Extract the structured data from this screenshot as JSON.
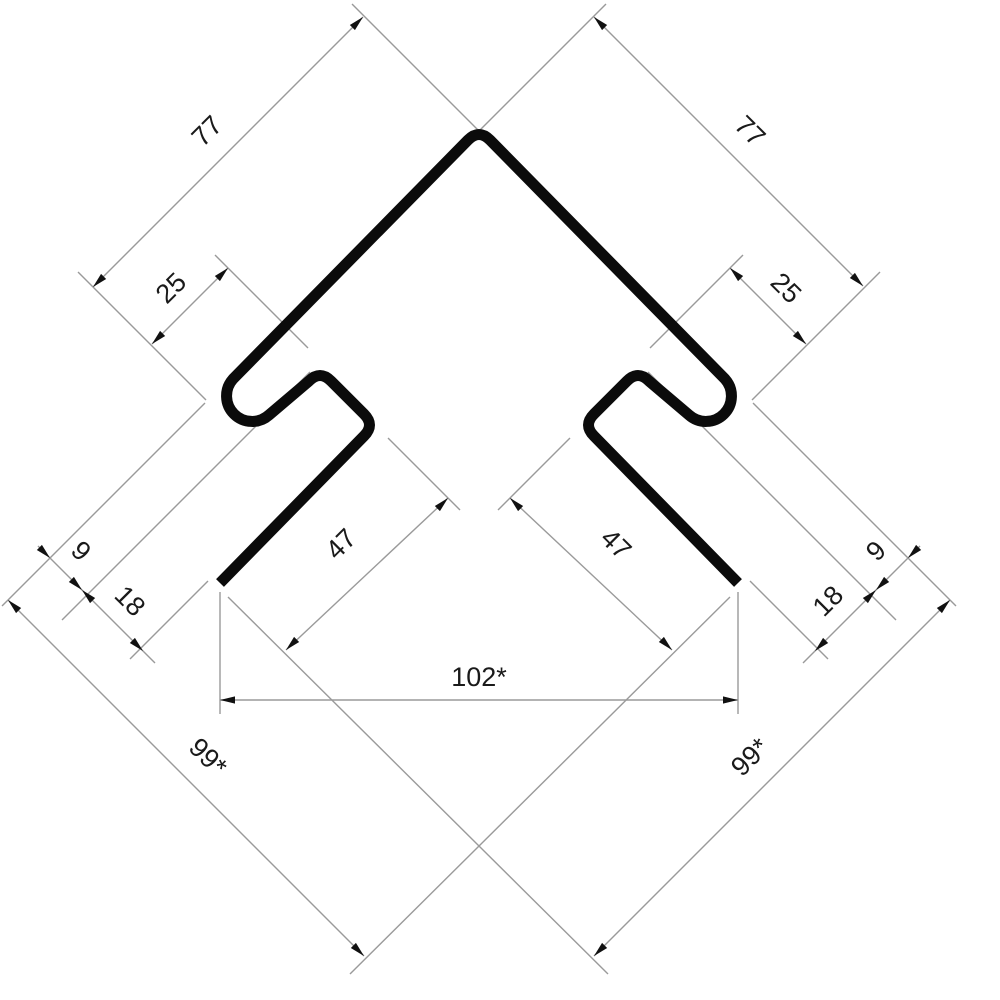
{
  "drawing": {
    "title": "corner-trim-profile-cross-section",
    "dims": {
      "l77": "77",
      "r77": "77",
      "l25": "25",
      "r25": "25",
      "l47": "47",
      "r47": "47",
      "l9": "9",
      "r9": "9",
      "l18": "18",
      "r18": "18",
      "w102": "102*",
      "l99": "99*",
      "r99": "99*"
    },
    "colors": {
      "profile": "#0b0b0b",
      "dimension_line": "#9a9a9a",
      "arrowhead": "#111111",
      "text": "#1a1a1a",
      "background": "#ffffff"
    }
  }
}
